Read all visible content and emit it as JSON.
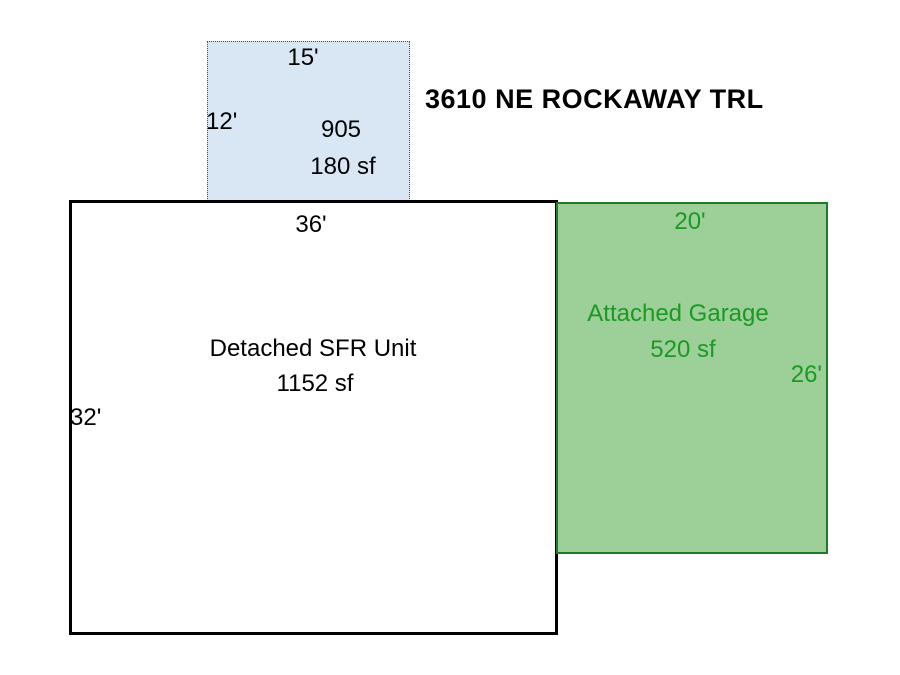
{
  "title": "3610 NE ROCKAWAY TRL",
  "colors": {
    "shed_fill": "#d9e7f5",
    "shed_border": "#4d4d4d",
    "house_border": "#000000",
    "garage_fill": "#9dcf98",
    "garage_border": "#1e7a24",
    "garage_text": "#1a9a23",
    "text": "#000000",
    "background": "#ffffff"
  },
  "buildings": {
    "shed": {
      "name": "905",
      "area": "180 sf",
      "top_dim": "15'",
      "left_dim": "12'"
    },
    "house": {
      "name": "Detached SFR Unit",
      "area": "1152 sf",
      "top_dim": "36'",
      "left_dim": "32'"
    },
    "garage": {
      "name": "Attached Garage",
      "area": "520 sf",
      "top_dim": "20'",
      "right_dim": "26'"
    }
  }
}
